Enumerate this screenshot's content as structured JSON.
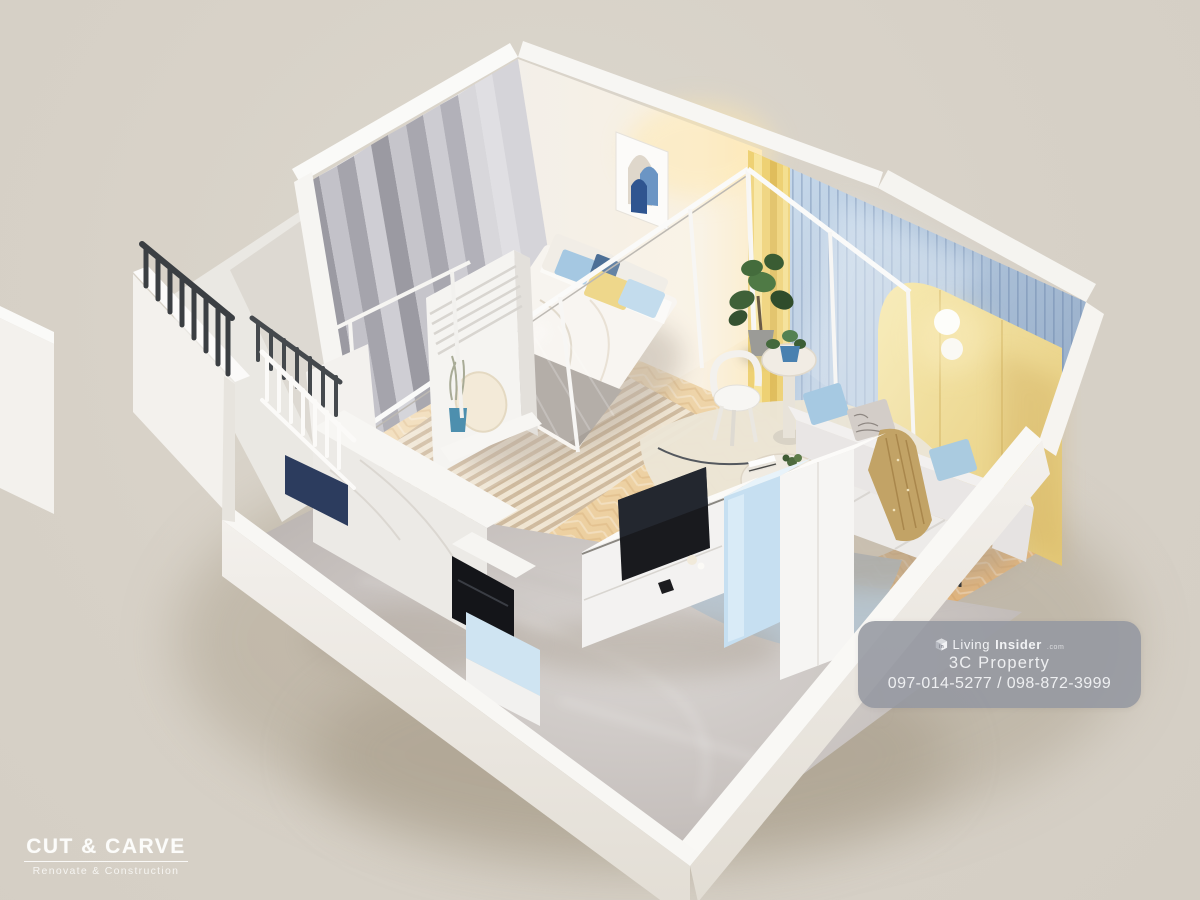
{
  "canvas": {
    "width": 1200,
    "height": 900,
    "background": "#d7d1c7"
  },
  "scene": {
    "type": "3d-isometric-condo-cutaway-render",
    "rooms": [
      "bedroom",
      "living-room",
      "tv-hallway",
      "kitchen-entry",
      "balcony"
    ],
    "palette": {
      "background": "#d7d1c7",
      "wall_white": "#f7f5f2",
      "accent_yellow_wardrobe": "#eed88d",
      "accent_yellow_curtain": "#eed174",
      "balcony_slat_wall_blue": "#a9bdd6",
      "light_blue_cabinet": "#cfe4f2",
      "wood_floor": "#e9c995",
      "marble_floor": "#c8c2bf",
      "curtain_grey": "#a3a2aa",
      "pillow_blue": "#a6c9e2",
      "pillow_yellow": "#ecd179",
      "sofa_grey": "#e9e6e5",
      "railing_dark": "#3c4043",
      "entry_mat_navy": "#2c3c5e",
      "badge_grey": "#9497a1"
    }
  },
  "watermark_logo": {
    "title": "CUT & CARVE",
    "subtitle": "Renovate & Construction"
  },
  "info_badge": {
    "brand": {
      "icon": "living-insider-cube-icon",
      "prefix": "Living",
      "suffix": "Insider",
      "tld": ".com"
    },
    "company": "3C Property",
    "phones": "097-014-5277 / 098-872-3999"
  }
}
